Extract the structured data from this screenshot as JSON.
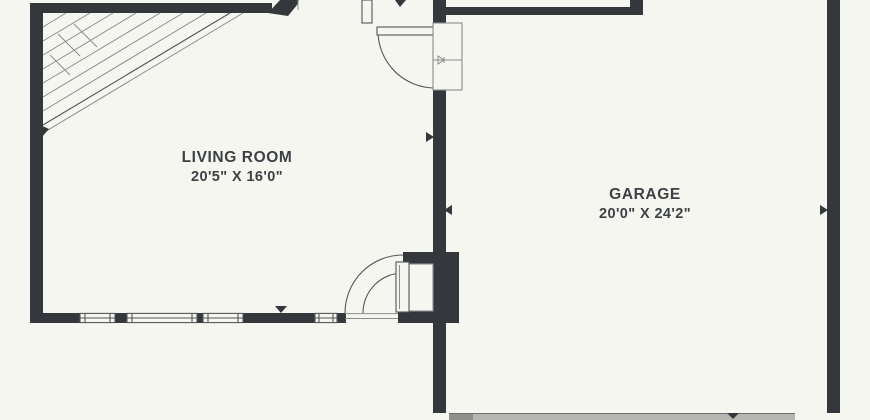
{
  "plan": {
    "type": "floor-plan",
    "rooms": [
      {
        "name": "LIVING ROOM",
        "dimensions": "20'5\" X 16'0\""
      },
      {
        "name": "GARAGE",
        "dimensions": "20'0\" X 24'2\""
      }
    ],
    "features": [
      "staircase",
      "door-swing",
      "windows",
      "garage-door",
      "water-heater"
    ]
  },
  "colors": {
    "background": "#f6f6f0",
    "wall": "#34383c",
    "thin_line": "#54575a",
    "text": "#3d4145",
    "garage_door": "#b5b5b1"
  }
}
